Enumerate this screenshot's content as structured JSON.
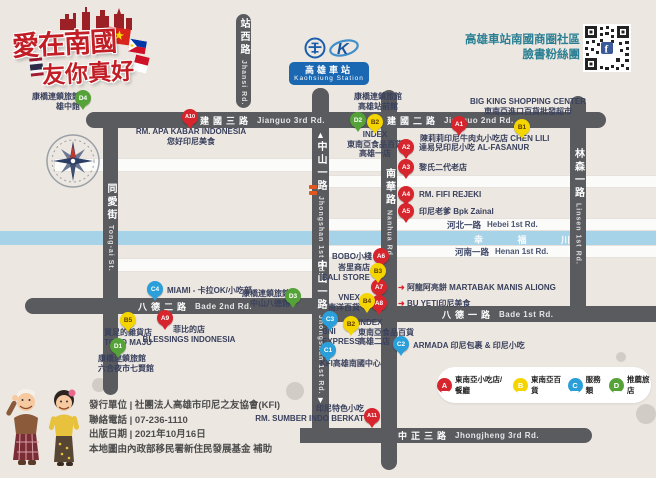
{
  "title_logo": {
    "line1": "愛在南國",
    "line2": "友你真好"
  },
  "header": {
    "fb_line1": "高雄車站南國商圈社區",
    "fb_line2": "臉書粉絲團",
    "qr_icon": "facebook-f"
  },
  "station": {
    "zh": "高雄車站",
    "en": "Kaohsiung Station"
  },
  "roads": {
    "jianguo3": {
      "zh": "建國三路",
      "en": "Jianguo 3rd Rd."
    },
    "jianguo2": {
      "zh": "建國二路",
      "en": "Jianguo 2nd Rd."
    },
    "jhansi": {
      "zh": "站西路",
      "en": "Jhansi Rd."
    },
    "tongai": {
      "zh": "同愛街",
      "en": "Tong-ai St."
    },
    "jhongshan": {
      "zh": "中山一路",
      "en": "Jhongshan 1st Rd."
    },
    "nanhua": {
      "zh": "南華路",
      "en": "Nanhua Rd."
    },
    "linsen": {
      "zh": "林森一路",
      "en": "Linsen 1st Rd."
    },
    "hebei": {
      "zh": "河北一路",
      "en": "Hebei 1st Rd."
    },
    "henan": {
      "zh": "河南一路",
      "en": "Henan 1st Rd."
    },
    "bade2": {
      "zh": "八德二路",
      "en": "Bade 2nd Rd."
    },
    "bade1": {
      "zh": "八德一路",
      "en": "Bade 1st Rd."
    },
    "jhongjheng": {
      "zh": "中正三路",
      "en": "Jhongjheng 3rd Rd."
    },
    "river": {
      "zh": "幸 福 川"
    }
  },
  "map": {
    "markers": [
      {
        "id": "A1",
        "x": 459,
        "y": 124,
        "lines": [
          "陳莉莉印尼牛肉丸小吃店 CHEN LILI"
        ],
        "lx": 420,
        "ly": 134,
        "lw": 150,
        "align": "left"
      },
      {
        "id": "A2",
        "x": 406,
        "y": 147,
        "lines": [
          "達易兒印尼小吃 AL-FASANUR"
        ],
        "lx": 419,
        "ly": 143,
        "lw": 130,
        "align": "left"
      },
      {
        "id": "A3",
        "x": 406,
        "y": 167,
        "lines": [
          "黎氏二代老店"
        ],
        "lx": 419,
        "ly": 163,
        "lw": 90,
        "align": "left"
      },
      {
        "id": "A4",
        "x": 406,
        "y": 194,
        "lines": [
          "RM. FIFI REJEKI"
        ],
        "lx": 419,
        "ly": 190,
        "lw": 90,
        "align": "left"
      },
      {
        "id": "A5",
        "x": 406,
        "y": 211,
        "lines": [
          "印尼老爹 Bpk Zainal"
        ],
        "lx": 419,
        "ly": 207,
        "lw": 110,
        "align": "left"
      },
      {
        "id": "A6",
        "x": 381,
        "y": 256,
        "lines": [
          "BOBO小棧"
        ],
        "lx": 314,
        "ly": 252,
        "lw": 58,
        "align": "right"
      },
      {
        "id": "A7",
        "x": 379,
        "y": 287,
        "arrow": true,
        "lines": [
          "阿龍阿亮餅 MARTABAK MANIS ALIONG"
        ],
        "lx": 398,
        "ly": 283,
        "lw": 175,
        "align": "left"
      },
      {
        "id": "A8",
        "x": 379,
        "y": 303,
        "arrow": true,
        "lines": [
          "BU YETI印尼美食"
        ],
        "lx": 398,
        "ly": 299,
        "lw": 110,
        "align": "left"
      },
      {
        "id": "A9",
        "x": 165,
        "y": 318,
        "lines": [
          "菲比的店",
          "BLESSINGS INDONESIA"
        ],
        "lx": 140,
        "ly": 325,
        "lw": 98,
        "align": "center"
      },
      {
        "id": "A10",
        "x": 190,
        "y": 117,
        "lines": [
          "RM. APA KABAR INDONESIA",
          "您好印尼美食"
        ],
        "lx": 130,
        "ly": 127,
        "lw": 122,
        "align": "center"
      },
      {
        "id": "A11",
        "x": 372,
        "y": 416,
        "lines": [
          "印尼特色小吃",
          "RM. SUMBER INDO BERKAT"
        ],
        "lx": 252,
        "ly": 404,
        "lw": 112,
        "align": "right"
      },
      {
        "id": "B1",
        "x": 522,
        "y": 127,
        "lines": [
          "BIG KING SHOPPING CENTER",
          "東南亞進口百貨批發超市"
        ],
        "lx": 466,
        "ly": 97,
        "lw": 124,
        "align": "center"
      },
      {
        "id": "B2",
        "x": 375,
        "y": 122,
        "lines": [
          "INDEX",
          "東南亞食品百貨",
          "高雄一店"
        ],
        "lx": 340,
        "ly": 130,
        "lw": 70,
        "align": "center"
      },
      {
        "id": "B2",
        "x": 351,
        "y": 324,
        "lines": [
          "INDEX",
          "東南亞食品百貨",
          "高雄二店"
        ],
        "lx": 358,
        "ly": 318,
        "lw": 70,
        "align": "left"
      },
      {
        "id": "B3",
        "x": 378,
        "y": 271,
        "lines": [
          "峇里商店",
          "BALI STORE"
        ],
        "lx": 314,
        "ly": 263,
        "lw": 56,
        "align": "right"
      },
      {
        "id": "B4",
        "x": 367,
        "y": 301,
        "lines": [
          "VNEX",
          "南洋百貨"
        ],
        "lx": 314,
        "ly": 293,
        "lw": 46,
        "align": "right"
      },
      {
        "id": "B5",
        "x": 128,
        "y": 320,
        "lines": [
          "買足的雜貨店",
          "TOKO MAJU"
        ],
        "lx": 92,
        "ly": 328,
        "lw": 72,
        "align": "center"
      },
      {
        "id": "C1",
        "x": 328,
        "y": 350,
        "lines": [
          "KFI高雄南國中心"
        ],
        "lx": 320,
        "ly": 359,
        "lw": 95,
        "align": "left"
      },
      {
        "id": "C2",
        "x": 401,
        "y": 344,
        "lines": [
          "ARMADA 印尼包裹 & 印尼小吃"
        ],
        "lx": 413,
        "ly": 341,
        "lw": 140,
        "align": "left"
      },
      {
        "id": "C3",
        "x": 330,
        "y": 319,
        "lines": [
          "BNI",
          "EXPRESS"
        ],
        "lx": 322,
        "ly": 327,
        "lw": 55,
        "align": "left"
      },
      {
        "id": "C4",
        "x": 155,
        "y": 289,
        "lines": [
          "MIAMI - 卡拉OK/小吃部"
        ],
        "lx": 167,
        "ly": 286,
        "lw": 115,
        "align": "left"
      },
      {
        "id": "D1",
        "x": 118,
        "y": 346,
        "lines": [
          "康橋連鎖旅館",
          "六合夜市七賢館"
        ],
        "lx": 98,
        "ly": 354,
        "lw": 75,
        "align": "left"
      },
      {
        "id": "D2",
        "x": 358,
        "y": 120,
        "lines": [
          "康橋連鎖旅館",
          "高雄站前館"
        ],
        "lx": 344,
        "ly": 92,
        "lw": 68,
        "align": "center"
      },
      {
        "id": "D3",
        "x": 293,
        "y": 296,
        "lines": [
          "康橋連鎖旅館",
          "中山八德館"
        ],
        "lx": 228,
        "ly": 289,
        "lw": 62,
        "align": "right"
      },
      {
        "id": "D4",
        "x": 83,
        "y": 98,
        "lines": [
          "康橋連鎖旅館",
          "雄中館"
        ],
        "lx": 20,
        "ly": 92,
        "lw": 60,
        "align": "right"
      }
    ]
  },
  "legend": {
    "items": [
      {
        "id": "A",
        "label": "東南亞小吃店/餐廳",
        "color": "#d6252d"
      },
      {
        "id": "B",
        "label": "東南亞百貨",
        "color": "#f4d500"
      },
      {
        "id": "C",
        "label": "服務類",
        "color": "#2b9fd9"
      },
      {
        "id": "D",
        "label": "推薦旅店",
        "color": "#55a338"
      }
    ]
  },
  "footer": {
    "lines": [
      "發行單位 | 社團法人高雄市印尼之友協會(KFI)",
      "聯絡電話 | 07-236-1110",
      "出版日期 | 2021年10月16日",
      "本地圖由內政部移民署新住民發展基金 補助"
    ]
  },
  "colors": {
    "food": "#d6252d",
    "goods": "#f4d500",
    "service": "#2b9fd9",
    "hotel": "#55a338",
    "road": "#5a5b5f",
    "river": "#a7d3e8",
    "accent_teal": "#2a7f93",
    "station_blue": "#1a68b2",
    "title_red": "#c21e26",
    "background": "#ece7e1"
  }
}
